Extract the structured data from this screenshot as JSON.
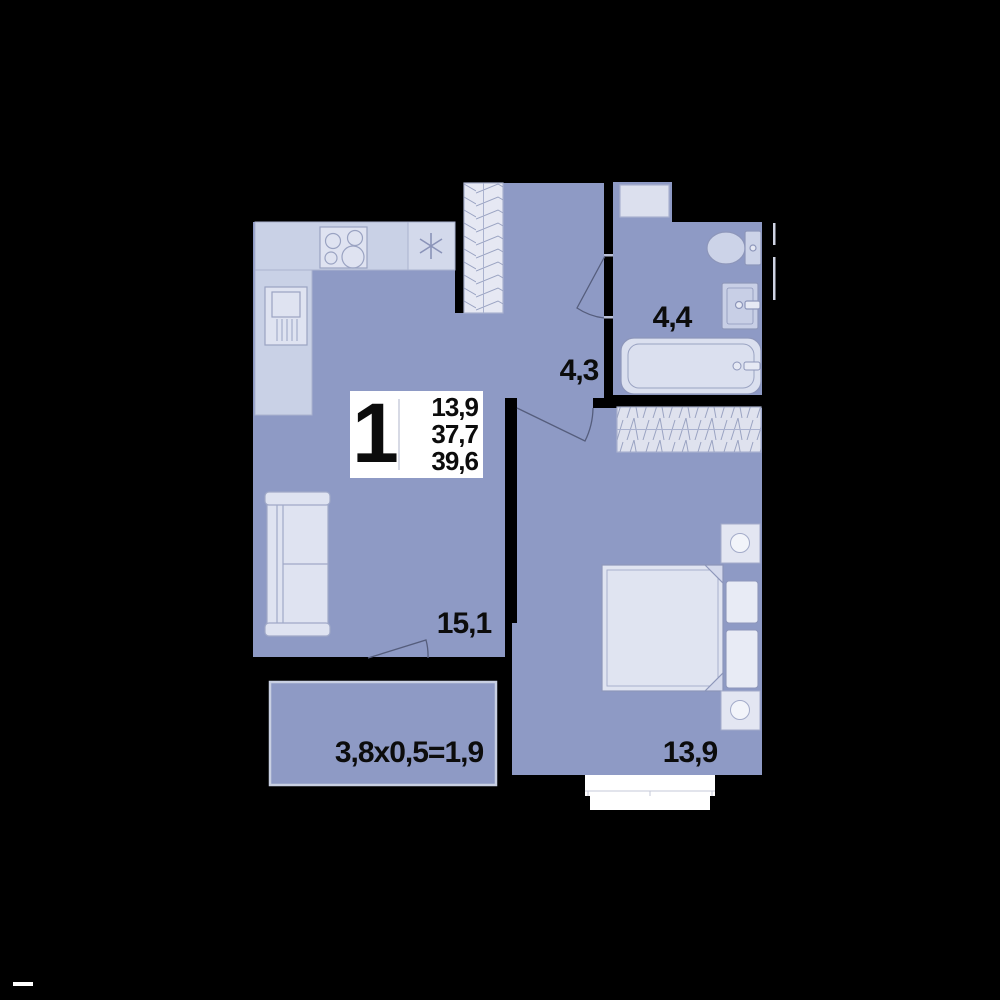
{
  "plan": {
    "unit_badge": {
      "rooms_count": "1",
      "area_line1": "13,9",
      "area_line2": "37,7",
      "area_line3": "39,6"
    },
    "rooms": [
      {
        "id": "kitchen-living",
        "label": "15,1"
      },
      {
        "id": "hallway",
        "label": "4,3"
      },
      {
        "id": "bathroom",
        "label": "4,4"
      },
      {
        "id": "bedroom",
        "label": "13,9"
      },
      {
        "id": "balcony",
        "label": "3,8x0,5=1,9"
      }
    ],
    "icons": [
      "stove-icon",
      "kitchen-sink-icon",
      "fridge-icon",
      "sofa-icon",
      "wardrobe-icon",
      "washing-machine-icon",
      "toilet-icon",
      "bath-sink-icon",
      "bathtub-icon",
      "bed-icon",
      "pillow-icon",
      "nightstand-icon",
      "door-swing-icon",
      "window-icon"
    ],
    "colors": {
      "background": "#000000",
      "floor": "#8e9ac5",
      "counter": "#c9d1e6",
      "furniture_light": "#dfe3f1",
      "fixture": "#ccd3e8",
      "wardrobe_fill": "#e6e8f3",
      "outline": "#8f98bb",
      "door_stroke": "#555d7c",
      "white": "#ffffff",
      "label_text": "#0c0c0c"
    }
  }
}
